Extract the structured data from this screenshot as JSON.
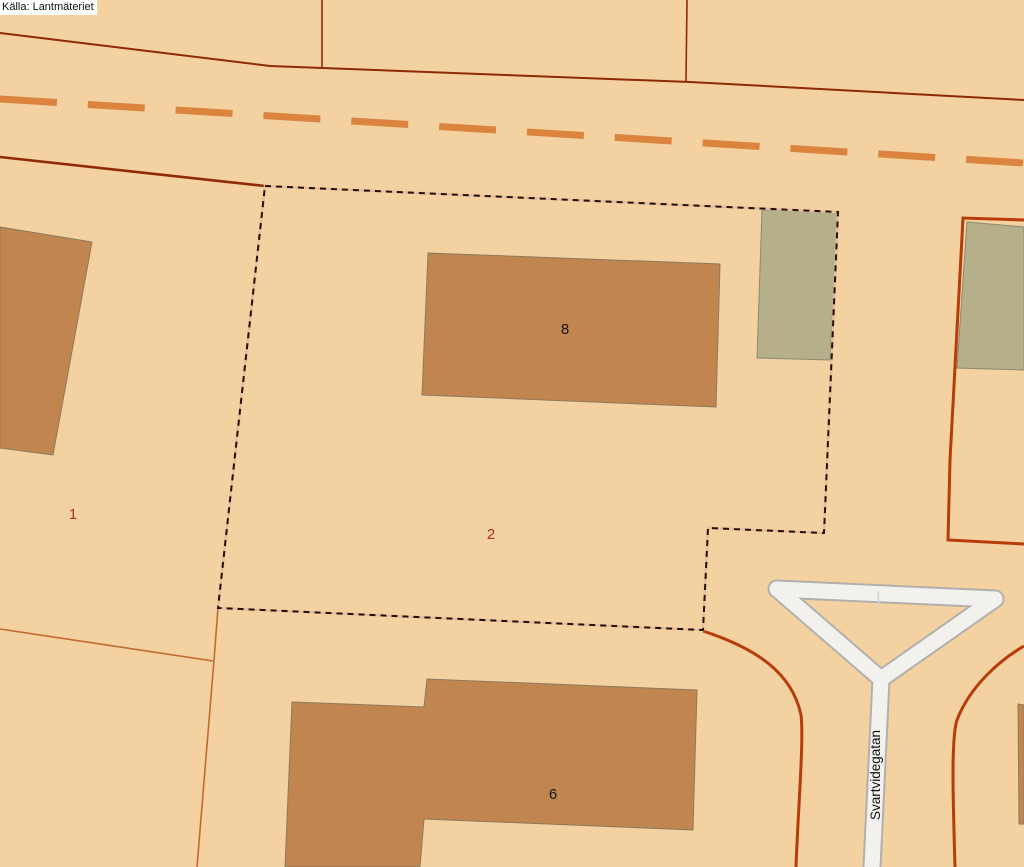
{
  "map": {
    "source_label": "Källa: Lantmäteriet",
    "street": {
      "name": "Svartvidegatan"
    },
    "parcels": [
      {
        "number": "1"
      },
      {
        "number": "2"
      }
    ],
    "buildings": [
      {
        "number": "8"
      },
      {
        "number": "6"
      }
    ],
    "colors": {
      "background": "#f3d1a0",
      "building_fill": "#c1854f",
      "outbuilding_fill": "#b5af8a",
      "boundary_dark_red": "#8e2a05",
      "boundary_accent_red": "#b63d0a",
      "boundary_light_brown": "#c06a30",
      "road_centerline_orange": "#da8440",
      "property_dash_black": "#201208",
      "property_dash_gap": "#e9bd99",
      "road_fill_white": "#f2f1ee",
      "road_casing_grey": "#b2b0ac",
      "parcel_label_red": "#a43420",
      "building_label_black": "#151515"
    }
  }
}
